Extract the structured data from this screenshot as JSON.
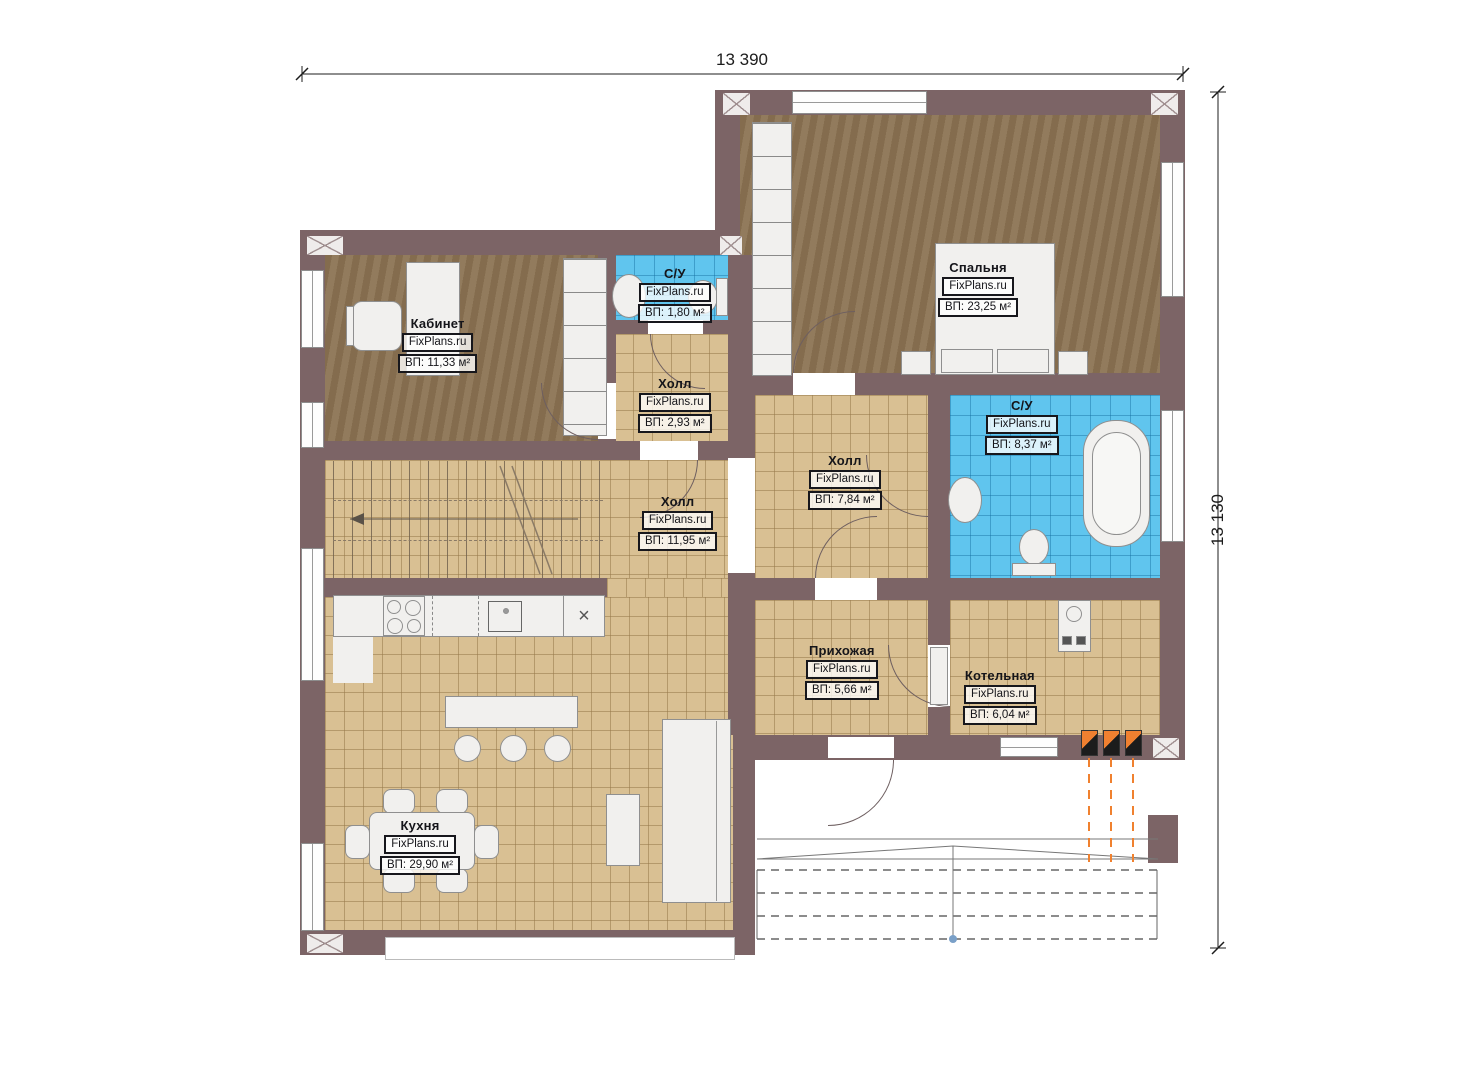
{
  "dimensions": {
    "width": "13 390",
    "height": "13 130"
  },
  "rooms": [
    {
      "id": "office",
      "name": "Кабинет",
      "watermark": "FixPlans.ru",
      "area": "ВП: 11,33 м²"
    },
    {
      "id": "wc-small",
      "name": "С/У",
      "watermark": "FixPlans.ru",
      "area": "ВП: 1,80 м²"
    },
    {
      "id": "hall-small",
      "name": "Холл",
      "watermark": "FixPlans.ru",
      "area": "ВП: 2,93 м²"
    },
    {
      "id": "bedroom",
      "name": "Спальня",
      "watermark": "FixPlans.ru",
      "area": "ВП: 23,25 м²"
    },
    {
      "id": "bathroom",
      "name": "С/У",
      "watermark": "FixPlans.ru",
      "area": "ВП: 8,37 м²"
    },
    {
      "id": "hall-mid",
      "name": "Холл",
      "watermark": "FixPlans.ru",
      "area": "ВП: 7,84 м²"
    },
    {
      "id": "hall-stairs",
      "name": "Холл",
      "watermark": "FixPlans.ru",
      "area": "ВП: 11,95 м²"
    },
    {
      "id": "entry",
      "name": "Прихожая",
      "watermark": "FixPlans.ru",
      "area": "ВП: 5,66 м²"
    },
    {
      "id": "boiler",
      "name": "Котельная",
      "watermark": "FixPlans.ru",
      "area": "ВП: 6,04 м²"
    },
    {
      "id": "kitchen",
      "name": "Кухня",
      "watermark": "FixPlans.ru",
      "area": "ВП: 29,90 м²"
    }
  ],
  "icons": {
    "appliance_x": "×"
  },
  "colors": {
    "wall": "#7c6466",
    "wood_floor": "#8c7454",
    "tile_floor": "#d9c093",
    "wet_tile_floor": "#60c5ee",
    "gas_accent": "#f0812f"
  }
}
